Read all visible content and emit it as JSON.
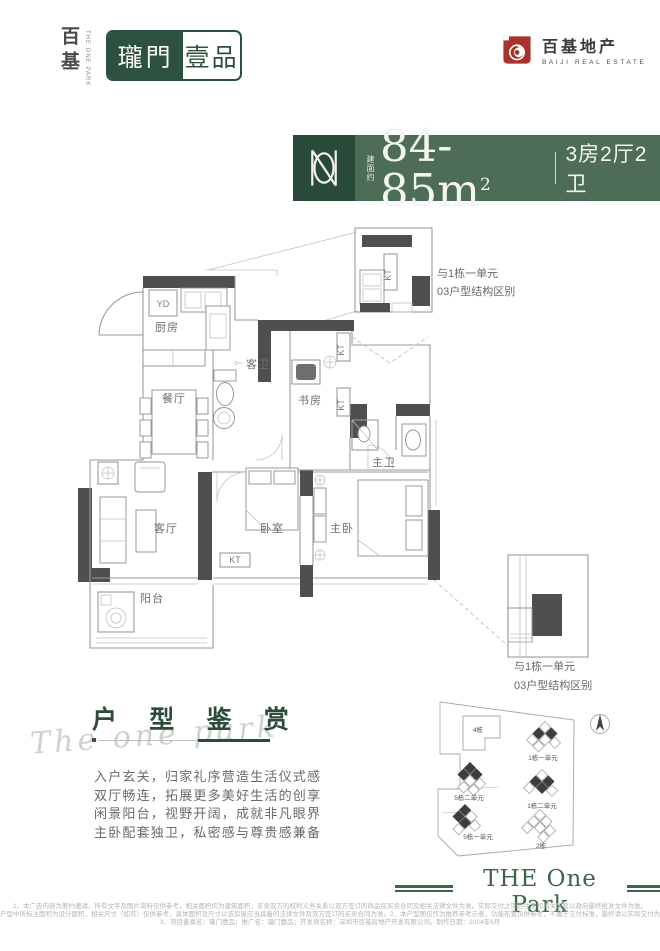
{
  "colors": {
    "banner_green": "#4d6d57",
    "monogram_green": "#2a4a39",
    "logo_green": "#2d513f",
    "heading_green": "#2c4b3a",
    "brand_red": "#ab322c",
    "wall_gray": "#4f4f4f"
  },
  "header": {
    "brand_cn": "百基",
    "brand_en_vertical": "THE ONE PARK",
    "logo_left": "瓏門",
    "logo_right": "壹品",
    "developer_cn": "百基地产",
    "developer_en": "BAIJI REAL ESTATE"
  },
  "headline": {
    "area_label": "建面约",
    "area_value": "84-85m",
    "area_sup": "2",
    "spec": "3房2厅2卫"
  },
  "floorplan": {
    "rooms": {
      "yd": "YD",
      "kitchen": "厨房",
      "dining": "餐厅",
      "guest_bath": "客卫",
      "study": "书房",
      "living": "客厅",
      "bedroom": "卧室",
      "master_bedroom": "主卧",
      "master_bath": "主卫",
      "balcony": "阳台",
      "kt": "KT"
    },
    "callout_top": {
      "line1": "与1栋一单元",
      "line2": "03户型结构区别"
    },
    "callout_bottom": {
      "line1": "与1栋一单元",
      "line2": "03户型结构区别"
    }
  },
  "appreciation": {
    "watermark": "The one park",
    "title": "户 型 鉴 赏",
    "lines": [
      "入户玄关，归家礼序营造生活仪式感",
      "双厅畅连，拓展更多美好生活的创享",
      "闲景阳台，视野开阔，成就非凡眼界",
      "主卧配套独卫，私密感与尊贵感兼备"
    ]
  },
  "siteplan": {
    "building4": "4栋",
    "b1u1": "1栋一单元",
    "b5u2": "5栋二单元",
    "b1u2": "1栋二单元",
    "b5u1": "5栋一单元",
    "building2": "2栋"
  },
  "footer": {
    "banner": "THE One Park",
    "disclaimer": [
      "1、本广告内容为要约邀请，所有文字及图片资料仅供参考，相关面积均为建筑面积，买卖双方的权利义务关系以双方签订的商品房买卖合同及相关法律文件为准。实际交付之项目住宅和相关配套以政府最终批准文件为准。",
      "户型中所标注面积为设计面积，相关尺寸（如有）仅供参考，具体面积及尺寸以该房屋应当具备的法律文件及双方签订的买卖合同为准。2、本户型图仅作为推荐参考示意，功能布置仅供参考，不属于交付标准，最终请以实际交付为准。",
      "3、项目备案名：瓏门壹品；推广名：瓏门壹品；开发商名称：深圳市百基房地产开发有限公司。制作日期：2024年6月"
    ]
  }
}
